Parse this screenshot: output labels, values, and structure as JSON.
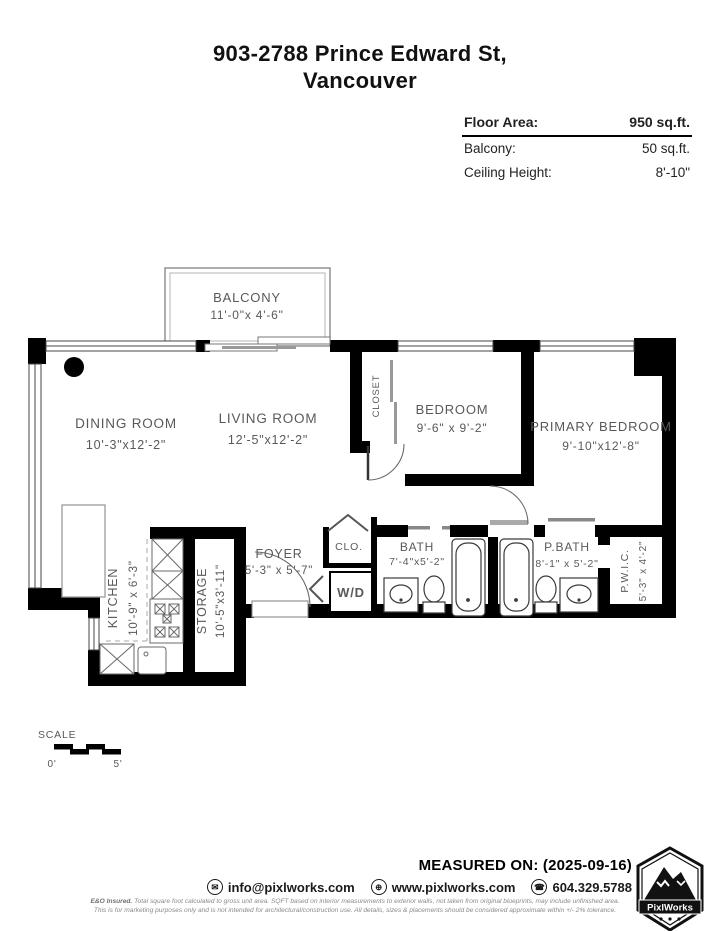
{
  "header": {
    "title_line1": "903-2788 Prince Edward St,",
    "title_line2": "Vancouver"
  },
  "info_panel": {
    "floor_area_label": "Floor Area:",
    "floor_area_value": "950 sq.ft.",
    "balcony_label": "Balcony:",
    "balcony_value": "50 sq.ft.",
    "ceiling_label": "Ceiling Height:",
    "ceiling_value": "8'-10\""
  },
  "floor_plan": {
    "rooms": {
      "balcony": {
        "name": "BALCONY",
        "dims": "11'-0\"x 4'-6\""
      },
      "dining": {
        "name": "DINING ROOM",
        "dims": "10'-3\"x12'-2\""
      },
      "living": {
        "name": "LIVING ROOM",
        "dims": "12'-5\"x12'-2\""
      },
      "closet": {
        "name": "CLOSET"
      },
      "bedroom": {
        "name": "BEDROOM",
        "dims": "9'-6\" x 9'-2\""
      },
      "primary": {
        "name": "PRIMARY BEDROOM",
        "dims": "9'-10\"x12'-8\""
      },
      "kitchen": {
        "name": "KITCHEN",
        "dims": "10'-9\" x 6'-3\""
      },
      "storage": {
        "name": "STORAGE",
        "dims": "10'-5\"x3'-11\""
      },
      "foyer": {
        "name": "FOYER",
        "dims": "5'-3\" x 5'-7\""
      },
      "clo": {
        "name": "CLO."
      },
      "wd": {
        "name": "W/D"
      },
      "bath": {
        "name": "BATH",
        "dims": "7'-4\"x5'-2\""
      },
      "pbath": {
        "name": "P.BATH",
        "dims": "8'-1\" x 5'-2\""
      },
      "pwic": {
        "name": "P.W.I.C.",
        "dims": "5'-3\" x 4'-2\""
      }
    },
    "scale": {
      "label": "SCALE",
      "start": "0'",
      "end": "5'"
    }
  },
  "footer": {
    "measured_on": "MEASURED ON: (2025-09-16)",
    "email": "info@pixlworks.com",
    "website": "www.pixlworks.com",
    "phone": "604.329.5788",
    "logo_text": "PixlWorks",
    "disclaimer_bold": "E&O Insured.",
    "disclaimer_rest": " Total square foot calculated to gross unit area. SQFT based on interior measurements to exterior walls, not taken from original blueprints, may include unfinished area.",
    "disclaimer_line2": "This is for marketing purposes only and is not intended for architectural/construction use.  All details, sizes & placements should be considered approximate within +/- 2%  tolerance."
  },
  "icons": {
    "email_glyph": "✉",
    "web_glyph": "⊕",
    "phone_glyph": "☎"
  },
  "colors": {
    "wall": "#000000",
    "room_label": "#58595b",
    "fixture": "#3a3a3a"
  }
}
